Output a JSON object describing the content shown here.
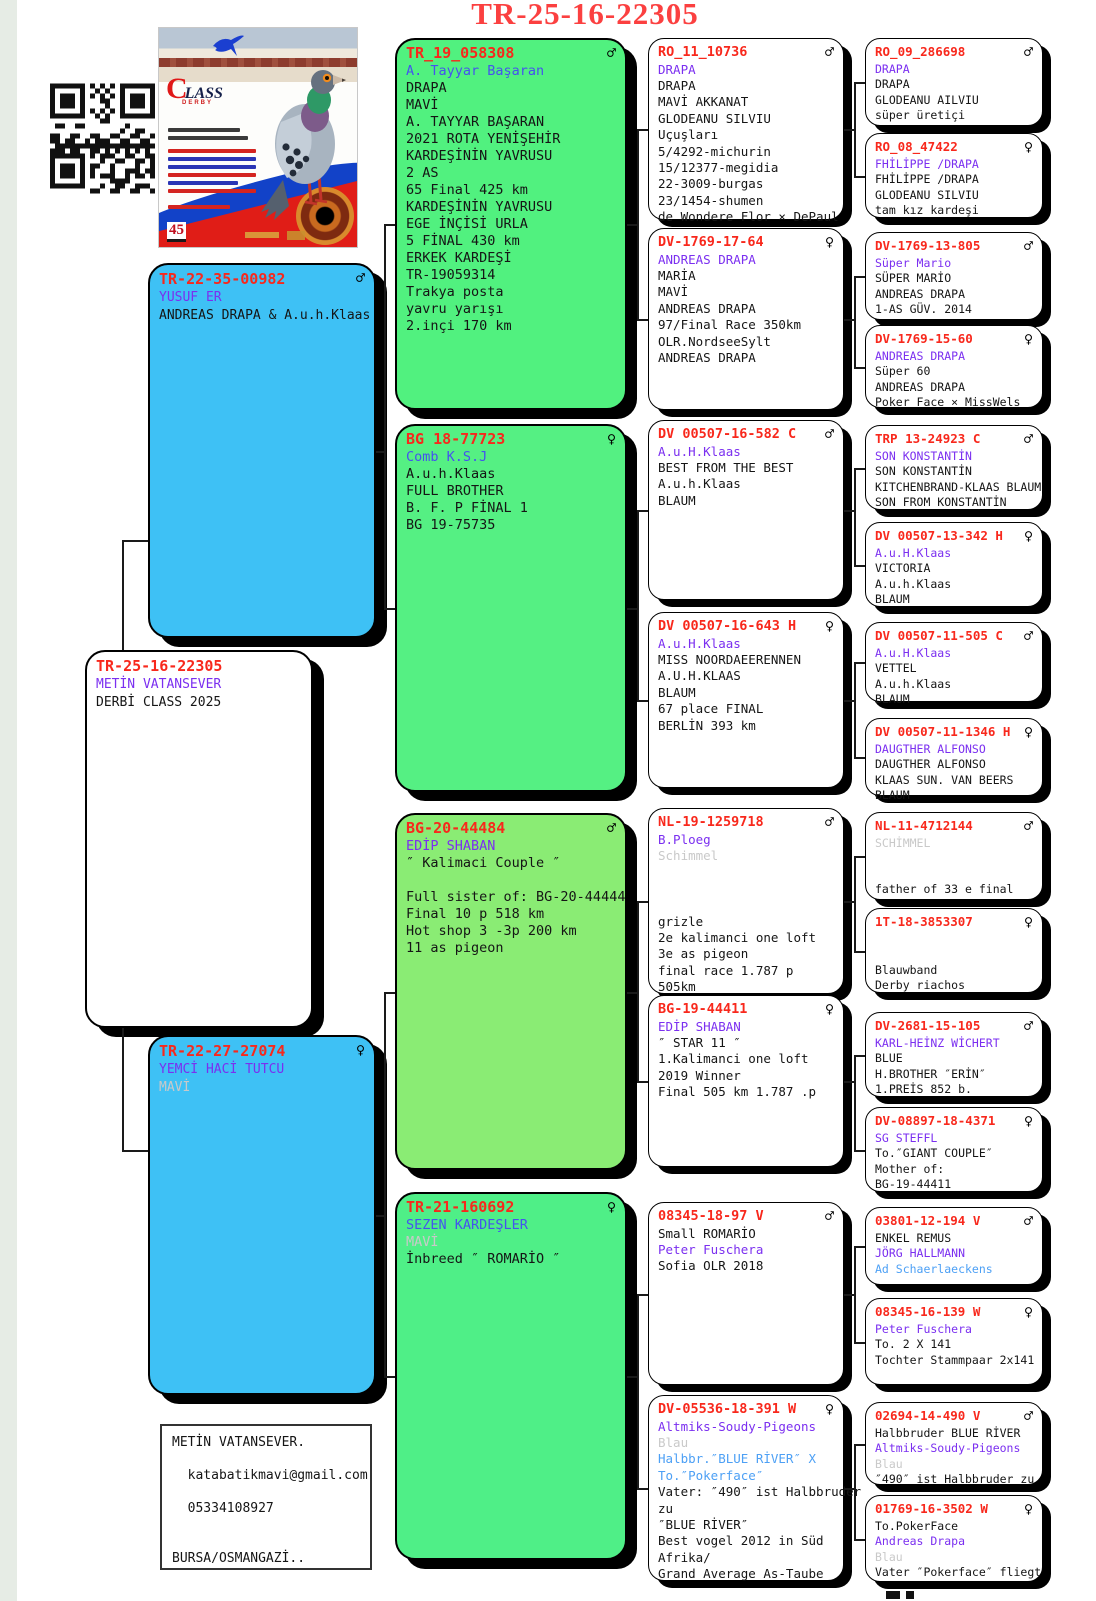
{
  "title": "TR-25-16-22305",
  "card": {
    "logo_c": "C",
    "logo_rest": "LASS",
    "logo_sub": "DERBY",
    "badge": "45"
  },
  "contact": {
    "lines": [
      {
        "t": "METİN VATANSEVER.",
        "c": "k"
      },
      {
        "t": "",
        "c": "k"
      },
      {
        "t": "  katabatikmavi@gmail.com",
        "c": "k"
      },
      {
        "t": "",
        "c": "k"
      },
      {
        "t": "  05334108927",
        "c": "k"
      },
      {
        "t": "",
        "c": "k"
      },
      {
        "t": "",
        "c": "k"
      },
      {
        "t": "BURSA/OSMANGAZİ..",
        "c": "k"
      }
    ]
  },
  "boxes": {
    "father": {
      "ring": "TR-22-35-00982",
      "sex": "♂",
      "lines": [
        {
          "t": "YUSUF ER",
          "c": "p"
        },
        {
          "t": "ANDREAS DRAPA & A.u.h.Klaas",
          "c": "k"
        }
      ]
    },
    "subject": {
      "ring": "TR-25-16-22305",
      "sex": "",
      "lines": [
        {
          "t": "METİN VATANSEVER",
          "c": "p"
        },
        {
          "t": "DERBİ CLASS 2025",
          "c": "k"
        }
      ]
    },
    "mother": {
      "ring": "TR-22-27-27074",
      "sex": "♀",
      "lines": [
        {
          "t": "YEMCİ HACİ TUTCU",
          "c": "p"
        },
        {
          "t": "MAVİ",
          "c": "g"
        }
      ]
    },
    "g1": {
      "ring": "TR_19_058308",
      "sex": "♂",
      "lines": [
        {
          "t": "A. Tayyar Başaran",
          "c": "u"
        },
        {
          "t": "DRAPA",
          "c": "k"
        },
        {
          "t": "MAVİ",
          "c": "k"
        },
        {
          "t": "A. TAYYAR BAŞARAN",
          "c": "k"
        },
        {
          "t": "2021 ROTA YENİŞEHİR",
          "c": "k"
        },
        {
          "t": "KARDEŞİNİN YAVRUSU",
          "c": "k"
        },
        {
          "t": "2 AS",
          "c": "k"
        },
        {
          "t": "65 Final 425 km",
          "c": "k"
        },
        {
          "t": "KARDEŞİNİN YAVRUSU",
          "c": "k"
        },
        {
          "t": "EGE İNÇİSİ URLA",
          "c": "k"
        },
        {
          "t": "5 FİNAL 430 km",
          "c": "k"
        },
        {
          "t": "ERKEK KARDEŞİ",
          "c": "k"
        },
        {
          "t": "TR-19059314",
          "c": "k"
        },
        {
          "t": "Trakya posta",
          "c": "k"
        },
        {
          "t": "yavru yarışı",
          "c": "k"
        },
        {
          "t": "2.inçi 170 km",
          "c": "k"
        }
      ]
    },
    "g2": {
      "ring": "BG 18-77723",
      "sex": "♀",
      "lines": [
        {
          "t": "Comb K.S.J",
          "c": "u"
        },
        {
          "t": "A.u.h.Klaas",
          "c": "k"
        },
        {
          "t": "FULL BROTHER",
          "c": "k"
        },
        {
          "t": "B. F. P FİNAL 1",
          "c": "k"
        },
        {
          "t": "BG 19-75735",
          "c": "k"
        }
      ]
    },
    "g3": {
      "ring": "BG-20-44484",
      "sex": "♂",
      "lines": [
        {
          "t": "EDİP SHABAN",
          "c": "p"
        },
        {
          "t": "″ Kalimaci Couple ″",
          "c": "k"
        },
        {
          "t": "",
          "c": "k"
        },
        {
          "t": "Full sister of: BG-20-44444",
          "c": "k"
        },
        {
          "t": "Final 10 p 518 km",
          "c": "k"
        },
        {
          "t": "Hot shop 3 -3p 200 km",
          "c": "k"
        },
        {
          "t": "11 as pigeon",
          "c": "k"
        }
      ]
    },
    "g4": {
      "ring": "TR-21-160692",
      "sex": "♀",
      "lines": [
        {
          "t": "SEZEN KARDEŞLER",
          "c": "u"
        },
        {
          "t": "MAVİ",
          "c": "g"
        },
        {
          "t": "İnbreed ″ ROMARİO ″",
          "c": "k"
        }
      ]
    },
    "c3a": {
      "ring": "RO_11_10736",
      "sex": "♂",
      "lines": [
        {
          "t": "DRAPA",
          "c": "p"
        },
        {
          "t": "DRAPA",
          "c": "k"
        },
        {
          "t": "MAVİ AKKANAT",
          "c": "k"
        },
        {
          "t": "GLODEANU SILVIU",
          "c": "k"
        },
        {
          "t": "Uçuşları",
          "c": "k"
        },
        {
          "t": "5/4292-michurin",
          "c": "k"
        },
        {
          "t": "15/12377-megidia",
          "c": "k"
        },
        {
          "t": "22-3009-burgas",
          "c": "k"
        },
        {
          "t": "23/1454-shumen",
          "c": "k"
        },
        {
          "t": "de Wondere Flor × DePaul",
          "c": "k"
        }
      ]
    },
    "c3b": {
      "ring": "DV-1769-17-64",
      "sex": "♀",
      "lines": [
        {
          "t": "ANDREAS DRAPA",
          "c": "p"
        },
        {
          "t": "MARİA",
          "c": "k"
        },
        {
          "t": "MAVİ",
          "c": "k"
        },
        {
          "t": "ANDREAS DRAPA",
          "c": "k"
        },
        {
          "t": "97/Final Race 350km",
          "c": "k"
        },
        {
          "t": "OLR.NordseeSylt",
          "c": "k"
        },
        {
          "t": "ANDREAS DRAPA",
          "c": "k"
        }
      ]
    },
    "c3c": {
      "ring": "DV 00507-16-582 C",
      "sex": "♂",
      "lines": [
        {
          "t": "A.u.H.Klaas",
          "c": "p"
        },
        {
          "t": "BEST FROM THE BEST",
          "c": "k"
        },
        {
          "t": "A.u.h.Klaas",
          "c": "k"
        },
        {
          "t": "BLAUM",
          "c": "k"
        }
      ]
    },
    "c3d": {
      "ring": "DV 00507-16-643 H",
      "sex": "♀",
      "lines": [
        {
          "t": "A.u.H.Klaas",
          "c": "p"
        },
        {
          "t": "MISS NOORDAEERENNEN",
          "c": "k"
        },
        {
          "t": "A.U.H.KLAAS",
          "c": "k"
        },
        {
          "t": "BLAUM",
          "c": "k"
        },
        {
          "t": "67 place FINAL",
          "c": "k"
        },
        {
          "t": "BERLİN 393 km",
          "c": "k"
        }
      ]
    },
    "c3e": {
      "ring": "NL-19-1259718",
      "sex": "♂",
      "lines": [
        {
          "t": "B.Ploeg",
          "c": "p"
        },
        {
          "t": "Schimmel",
          "c": "g"
        },
        {
          "t": "",
          "c": "k"
        },
        {
          "t": "",
          "c": "k"
        },
        {
          "t": "",
          "c": "k"
        },
        {
          "t": "grizle",
          "c": "k"
        },
        {
          "t": "2e kalimanci one loft",
          "c": "k"
        },
        {
          "t": "3e as pigeon",
          "c": "k"
        },
        {
          "t": "final race 1.787 p",
          "c": "k"
        },
        {
          "t": "505km",
          "c": "k"
        }
      ]
    },
    "c3f": {
      "ring": "BG-19-44411",
      "sex": "♀",
      "lines": [
        {
          "t": "EDİP SHABAN",
          "c": "p"
        },
        {
          "t": "″ STAR 11 ″",
          "c": "k"
        },
        {
          "t": "1.Kalimanci one loft",
          "c": "k"
        },
        {
          "t": "2019 Winner",
          "c": "k"
        },
        {
          "t": "Final 505 km 1.787 .p",
          "c": "k"
        }
      ]
    },
    "c3g": {
      "ring": "08345-18-97 V",
      "sex": "♂",
      "lines": [
        {
          "t": "Small ROMARİO",
          "c": "k"
        },
        {
          "t": "Peter Fuschera",
          "c": "p"
        },
        {
          "t": "Sofia OLR 2018",
          "c": "k"
        }
      ]
    },
    "c3h": {
      "ring": "DV-05536-18-391 W",
      "sex": "♀",
      "lines": [
        {
          "t": "Altmiks-Soudy-Pigeons",
          "c": "p"
        },
        {
          "t": "Blau",
          "c": "g"
        },
        {
          "t": "Halbbr.″BLUE RİVER″ X",
          "c": "b"
        },
        {
          "t": "To.″Pokerface″",
          "c": "b"
        },
        {
          "t": "Vater: ″490″ ist Halbbruder",
          "c": "k"
        },
        {
          "t": "zu",
          "c": "k"
        },
        {
          "t": "″BLUE RİVER″",
          "c": "k"
        },
        {
          "t": "Best vogel 2012 in Süd",
          "c": "k"
        },
        {
          "t": "Afrika/",
          "c": "k"
        },
        {
          "t": "Grand Average As-Taube",
          "c": "k"
        }
      ]
    },
    "c4a": {
      "ring": "RO_09_286698",
      "sex": "♂",
      "lines": [
        {
          "t": "DRAPA",
          "c": "p"
        },
        {
          "t": "DRAPA",
          "c": "k"
        },
        {
          "t": "GLODEANU AILVIU",
          "c": "k"
        },
        {
          "t": "süper üretiçi",
          "c": "k"
        }
      ]
    },
    "c4b": {
      "ring": "RO_08_47422",
      "sex": "♀",
      "lines": [
        {
          "t": "FHİLİPPE /DRAPA",
          "c": "p"
        },
        {
          "t": "FHİLİPPE /DRAPA",
          "c": "k"
        },
        {
          "t": "GLODEANU SILVIU",
          "c": "k"
        },
        {
          "t": "tam kız kardeşi",
          "c": "k"
        }
      ]
    },
    "c4c": {
      "ring": "DV-1769-13-805",
      "sex": "♂",
      "lines": [
        {
          "t": "Süper Mario",
          "c": "p"
        },
        {
          "t": "SÜPER MARİO",
          "c": "k"
        },
        {
          "t": "ANDREAS DRAPA",
          "c": "k"
        },
        {
          "t": "1-AS GÜV. 2014",
          "c": "k"
        }
      ]
    },
    "c4d": {
      "ring": "DV-1769-15-60",
      "sex": "♀",
      "lines": [
        {
          "t": "ANDREAS DRAPA",
          "c": "p"
        },
        {
          "t": "Süper 60",
          "c": "k"
        },
        {
          "t": "ANDREAS DRAPA",
          "c": "k"
        },
        {
          "t": "Poker Face × MissWels",
          "c": "k"
        }
      ]
    },
    "c4e": {
      "ring": "TRP 13-24923 C",
      "sex": "♂",
      "lines": [
        {
          "t": "SON KONSTANTİN",
          "c": "p"
        },
        {
          "t": "SON KONSTANTİN",
          "c": "k"
        },
        {
          "t": "KITCHENBRAND-KLAAS BLAUM",
          "c": "k"
        },
        {
          "t": "SON FROM KONSTANTİN",
          "c": "k"
        }
      ]
    },
    "c4f": {
      "ring": "DV 00507-13-342 H",
      "sex": "♀",
      "lines": [
        {
          "t": "A.u.H.Klaas",
          "c": "p"
        },
        {
          "t": "VICTORIA",
          "c": "k"
        },
        {
          "t": "A.u.h.Klaas",
          "c": "k"
        },
        {
          "t": "BLAUM",
          "c": "k"
        }
      ]
    },
    "c4g": {
      "ring": "DV 00507-11-505 C",
      "sex": "♂",
      "lines": [
        {
          "t": "A.u.H.Klaas",
          "c": "p"
        },
        {
          "t": "VETTEL",
          "c": "k"
        },
        {
          "t": "A.u.h.Klaas",
          "c": "k"
        },
        {
          "t": "BLAUM",
          "c": "k"
        }
      ]
    },
    "c4h": {
      "ring": "DV 00507-11-1346 H",
      "sex": "♀",
      "lines": [
        {
          "t": "DAUGTHER ALFONSO",
          "c": "p"
        },
        {
          "t": "DAUGTHER ALFONSO",
          "c": "k"
        },
        {
          "t": "KLAAS SUN. VAN BEERS",
          "c": "k"
        },
        {
          "t": "BLAUM",
          "c": "k"
        }
      ]
    },
    "c4i": {
      "ring": "NL-11-4712144",
      "sex": "♂",
      "lines": [
        {
          "t": "SCHİMMEL",
          "c": "g"
        },
        {
          "t": "",
          "c": "k"
        },
        {
          "t": "",
          "c": "k"
        },
        {
          "t": "father of 33 e final",
          "c": "k"
        }
      ]
    },
    "c4j": {
      "ring": "1T-18-3853307",
      "sex": "♀",
      "lines": [
        {
          "t": "",
          "c": "k"
        },
        {
          "t": "",
          "c": "k"
        },
        {
          "t": "Blauwband",
          "c": "k"
        },
        {
          "t": "Derby riachos",
          "c": "k"
        }
      ]
    },
    "c4k": {
      "ring": "DV-2681-15-105",
      "sex": "♂",
      "lines": [
        {
          "t": "KARL-HEİNZ WİCHERT",
          "c": "p"
        },
        {
          "t": "BLUE",
          "c": "k"
        },
        {
          "t": "H.BROTHER ″ERİN″",
          "c": "k"
        },
        {
          "t": "1.PREİS 852 b.",
          "c": "k"
        }
      ]
    },
    "c4l": {
      "ring": "DV-08897-18-4371",
      "sex": "♀",
      "lines": [
        {
          "t": "SG STEFFL",
          "c": "p"
        },
        {
          "t": "To.″GIANT COUPLE″",
          "c": "k"
        },
        {
          "t": "Mother of:",
          "c": "k"
        },
        {
          "t": "BG-19-44411",
          "c": "k"
        }
      ]
    },
    "c4m": {
      "ring": "03801-12-194 V",
      "sex": "♂",
      "lines": [
        {
          "t": "ENKEL REMUS",
          "c": "k"
        },
        {
          "t": "JÖRG HALLMANN",
          "c": "p"
        },
        {
          "t": "Ad Schaerlaeckens",
          "c": "b"
        }
      ]
    },
    "c4n": {
      "ring": "08345-16-139 W",
      "sex": "♀",
      "lines": [
        {
          "t": "Peter Fuschera",
          "c": "p"
        },
        {
          "t": "To. 2 X 141",
          "c": "k"
        },
        {
          "t": "Tochter Stammpaar 2x141",
          "c": "k"
        }
      ]
    },
    "c4o": {
      "ring": "02694-14-490 V",
      "sex": "♂",
      "lines": [
        {
          "t": "Halbbruder BLUE RİVER",
          "c": "k"
        },
        {
          "t": "Altmiks-Soudy-Pigeons",
          "c": "p"
        },
        {
          "t": "Blau",
          "c": "g"
        },
        {
          "t": "″490″ ist Halbbruder zu",
          "c": "k"
        }
      ]
    },
    "c4p": {
      "ring": "01769-16-3502 W",
      "sex": "♀",
      "lines": [
        {
          "t": "To.PokerFace",
          "c": "k"
        },
        {
          "t": "Andreas Drapa",
          "c": "p"
        },
        {
          "t": "Blau",
          "c": "g"
        },
        {
          "t": "Vater ″Pokerface″ fliegt",
          "c": "k"
        }
      ]
    }
  }
}
